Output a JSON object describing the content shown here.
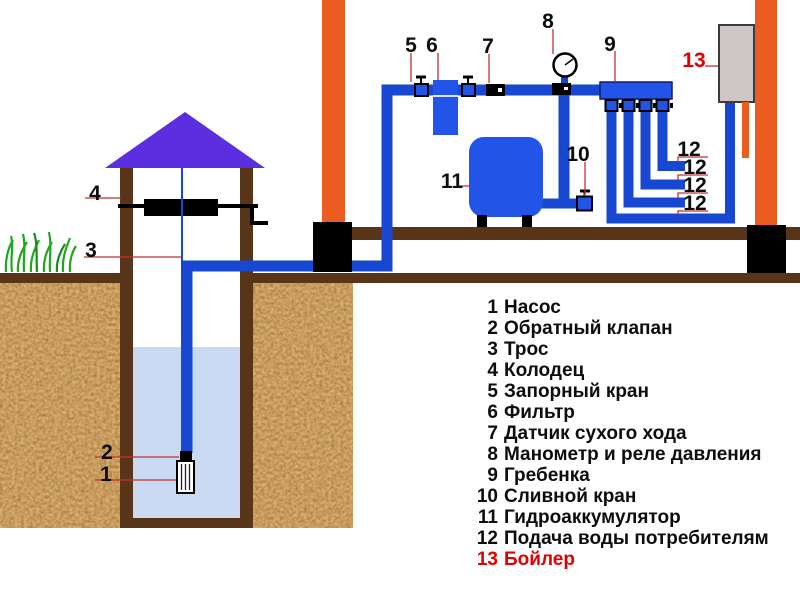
{
  "diagram": {
    "callouts": {
      "c1": "1",
      "c2": "2",
      "c3": "3",
      "c4": "4",
      "c5": "5",
      "c6": "6",
      "c7": "7",
      "c8": "8",
      "c9": "9",
      "c10": "10",
      "c11": "11",
      "c12": "12",
      "c13": "13"
    },
    "legend": {
      "items": [
        {
          "num": "1",
          "label": "Насос"
        },
        {
          "num": "2",
          "label": "Обратный клапан"
        },
        {
          "num": "3",
          "label": "Трос"
        },
        {
          "num": "4",
          "label": "Колодец"
        },
        {
          "num": "5",
          "label": "Запорный кран"
        },
        {
          "num": "6",
          "label": "Фильтр"
        },
        {
          "num": "7",
          "label": "Датчик сухого хода"
        },
        {
          "num": "8",
          "label": "Манометр и реле давления"
        },
        {
          "num": "9",
          "label": "Гребенка"
        },
        {
          "num": "10",
          "label": "Сливной кран"
        },
        {
          "num": "11",
          "label": "Гидроаккумулятор"
        },
        {
          "num": "12",
          "label": "Подача воды потребителям"
        },
        {
          "num": "13",
          "label": "Бойлер"
        }
      ]
    },
    "colors": {
      "pipe_blue": "#1847d2",
      "equipment_blue": "#2254e8",
      "roof_violet": "#5b2ee0",
      "column_orange": "#eb5c20",
      "dark_brown": "#583418",
      "water_blue": "#c8d9f1",
      "boiler_gray": "#cfc7c7",
      "label_red": "#e00000",
      "leader_red": "#c23030",
      "grass_green": "#1fa81f"
    }
  }
}
